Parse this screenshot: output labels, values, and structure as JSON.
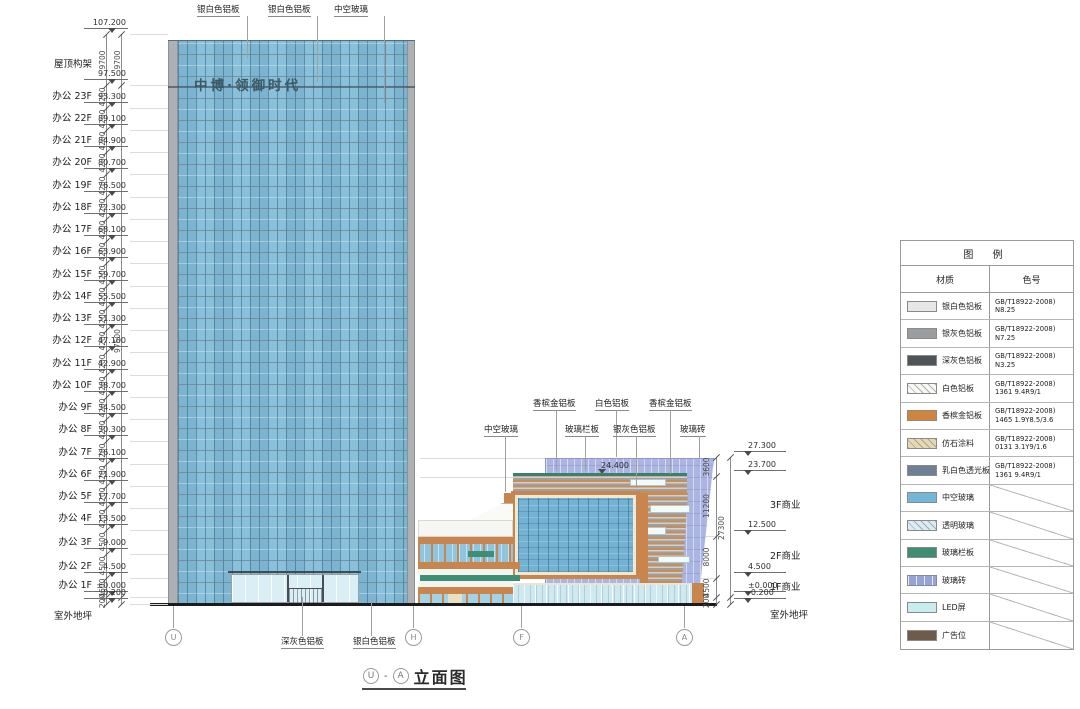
{
  "drawing_title": {
    "grid_start": "U",
    "separator": "-",
    "grid_end": "A",
    "name": "立面图"
  },
  "signs": {
    "tower": "中博·领御时代",
    "podium_small": "中博·领御时代"
  },
  "podium": {
    "top_elevation": "24.400"
  },
  "material_labels": {
    "top": [
      "银白色铝板",
      "银白色铝板",
      "中空玻璃"
    ],
    "mid_row1": [
      "香槟金铝板",
      "白色铝板",
      "香槟金铝板"
    ],
    "mid_row2": [
      "中空玻璃",
      "玻璃栏板",
      "银灰色铝板",
      "玻璃砖"
    ],
    "bottom": [
      "深灰色铝板",
      "银白色铝板"
    ]
  },
  "left_ladder": {
    "marks": [
      {
        "elev": "107.200"
      },
      {
        "label": "屋顶构架",
        "elev": "97.500"
      },
      {
        "label": "办公 23F",
        "elev": "93.300"
      },
      {
        "label": "办公 22F",
        "elev": "89.100"
      },
      {
        "label": "办公 21F",
        "elev": "84.900"
      },
      {
        "label": "办公 20F",
        "elev": "80.700"
      },
      {
        "label": "办公 19F",
        "elev": "76.500"
      },
      {
        "label": "办公 18F",
        "elev": "72.300"
      },
      {
        "label": "办公 17F",
        "elev": "68.100"
      },
      {
        "label": "办公 16F",
        "elev": "63.900"
      },
      {
        "label": "办公 15F",
        "elev": "59.700"
      },
      {
        "label": "办公 14F",
        "elev": "55.500"
      },
      {
        "label": "办公 13F",
        "elev": "51.300"
      },
      {
        "label": "办公 12F",
        "elev": "47.100"
      },
      {
        "label": "办公 11F",
        "elev": "42.900"
      },
      {
        "label": "办公 10F",
        "elev": "38.700"
      },
      {
        "label": "办公 9F",
        "elev": "34.500"
      },
      {
        "label": "办公 8F",
        "elev": "30.300"
      },
      {
        "label": "办公 7F",
        "elev": "26.100"
      },
      {
        "label": "办公 6F",
        "elev": "21.900"
      },
      {
        "label": "办公 5F",
        "elev": "17.700"
      },
      {
        "label": "办公 4F",
        "elev": "13.500"
      },
      {
        "label": "办公 3F",
        "elev": "9.000"
      },
      {
        "label": "办公 2F",
        "elev": "4.500"
      },
      {
        "label": "办公 1F",
        "elev": "±0.000"
      },
      {
        "label": "室外地坪",
        "elev": "-0.200"
      }
    ],
    "dims": [
      "9700",
      "4200",
      "4200",
      "4200",
      "4200",
      "4200",
      "4200",
      "4200",
      "4200",
      "4200",
      "4200",
      "4200",
      "4200",
      "4200",
      "4200",
      "4200",
      "4200",
      "4200",
      "4200",
      "4200",
      "4200",
      "4500",
      "4500",
      "4500",
      "200"
    ],
    "overall_dims": [
      "9700",
      "97500"
    ]
  },
  "right_ladder": {
    "marks": [
      {
        "elev": "27.300"
      },
      {
        "elev": "23.700"
      },
      {
        "label": "3F商业",
        "elev": "12.500"
      },
      {
        "label": "2F商业",
        "elev": "4.500"
      },
      {
        "label": "1F商业",
        "elev": "±0.000"
      },
      {
        "label": "室外地坪",
        "elev": "-0.200"
      }
    ],
    "dims": [
      "3600",
      "11200",
      "8000",
      "4500",
      "200"
    ],
    "overall_dim": "27300"
  },
  "grid_bubbles": [
    "U",
    "H",
    "F",
    "A"
  ],
  "legend": {
    "title": "图  例",
    "columns": [
      "材质",
      "色号"
    ],
    "rows": [
      {
        "material": "银白色铝板",
        "swatch": "silver_white",
        "code": [
          "GB/T18922-2008)",
          "N8.25"
        ]
      },
      {
        "material": "银灰色铝板",
        "swatch": "silver_gray",
        "code": [
          "GB/T18922-2008)",
          "N7.25"
        ]
      },
      {
        "material": "深灰色铝板",
        "swatch": "dark_gray",
        "code": [
          "GB/T18922-2008)",
          "N3.25"
        ]
      },
      {
        "material": "白色铝板",
        "swatch": "white_hatch",
        "code": [
          "GB/T18922-2008)",
          "1361 9.4R9/1"
        ]
      },
      {
        "material": "香槟金铝板",
        "swatch": "champagne",
        "code": [
          "GB/T18922-2008)",
          "1465 1.9Y8.5/3.6"
        ]
      },
      {
        "material": "仿石涂料",
        "swatch": "stone",
        "code": [
          "GB/T18922-2008)",
          "0131 3.1Y9/1.6"
        ]
      },
      {
        "material": "乳白色透光板",
        "swatch": "milky",
        "code": [
          "GB/T18922-2008)",
          "1361 9.4R9/1"
        ]
      },
      {
        "material": "中空玻璃",
        "swatch": "insulated_glass",
        "code": []
      },
      {
        "material": "透明玻璃",
        "swatch": "clear_glass",
        "code": []
      },
      {
        "material": "玻璃栏板",
        "swatch": "glass_rail",
        "code": []
      },
      {
        "material": "玻璃砖",
        "swatch": "glass_brick",
        "code": []
      },
      {
        "material": "LED屏",
        "swatch": "led",
        "code": []
      },
      {
        "material": "广告位",
        "swatch": "ad",
        "code": []
      }
    ]
  },
  "colors": {
    "silver_white": "#e6e7e6",
    "silver_gray": "#9b9ea1",
    "dark_gray": "#4f5457",
    "white_hatch": "#f8f8f4",
    "champagne": "#d0853f",
    "stone": "#e6d8b2",
    "milky": "#6e7f96",
    "insulated_glass": "#72b7d8",
    "clear_glass": "#d8edf5",
    "glass_rail": "#3e8e74",
    "glass_brick": "#96a3da",
    "led": "#c9ecee",
    "ad": "#6e5b49"
  }
}
